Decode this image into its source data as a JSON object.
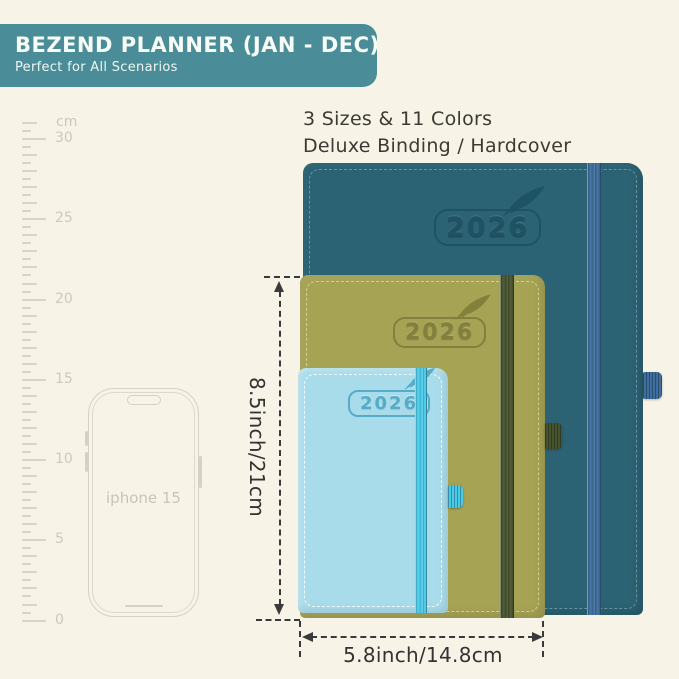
{
  "banner": {
    "title": "BEZEND PLANNER (JAN - DEC)",
    "subtitle": "Perfect for All Scenarios",
    "bg_color": "#4a8d99"
  },
  "info": {
    "line1": "3 Sizes & 11 Colors",
    "line2": "Deluxe Binding / Hardcover"
  },
  "ruler": {
    "unit": "cm",
    "start": 31,
    "end": 0,
    "step": 0.5,
    "top_y": 122,
    "px_per_cm": 16.05,
    "labels": [
      30,
      25,
      20,
      15,
      10,
      5,
      0
    ]
  },
  "phone": {
    "label": "iphone 15"
  },
  "planners": [
    {
      "id": "large",
      "year": "2026",
      "cover_color": "#2b6374",
      "band_color": "#3e6e9d"
    },
    {
      "id": "medium",
      "year": "2026",
      "cover_color": "#a6a355",
      "band_color": "#47542f"
    },
    {
      "id": "small",
      "year": "2026",
      "cover_color": "#a9dcea",
      "band_color": "#4ccae9"
    }
  ],
  "dimensions": {
    "height_label": "8.5inch/21cm",
    "width_label": "5.8inch/14.8cm"
  },
  "colors": {
    "background": "#f7f3e6",
    "annotation": "#3a3a3a"
  }
}
